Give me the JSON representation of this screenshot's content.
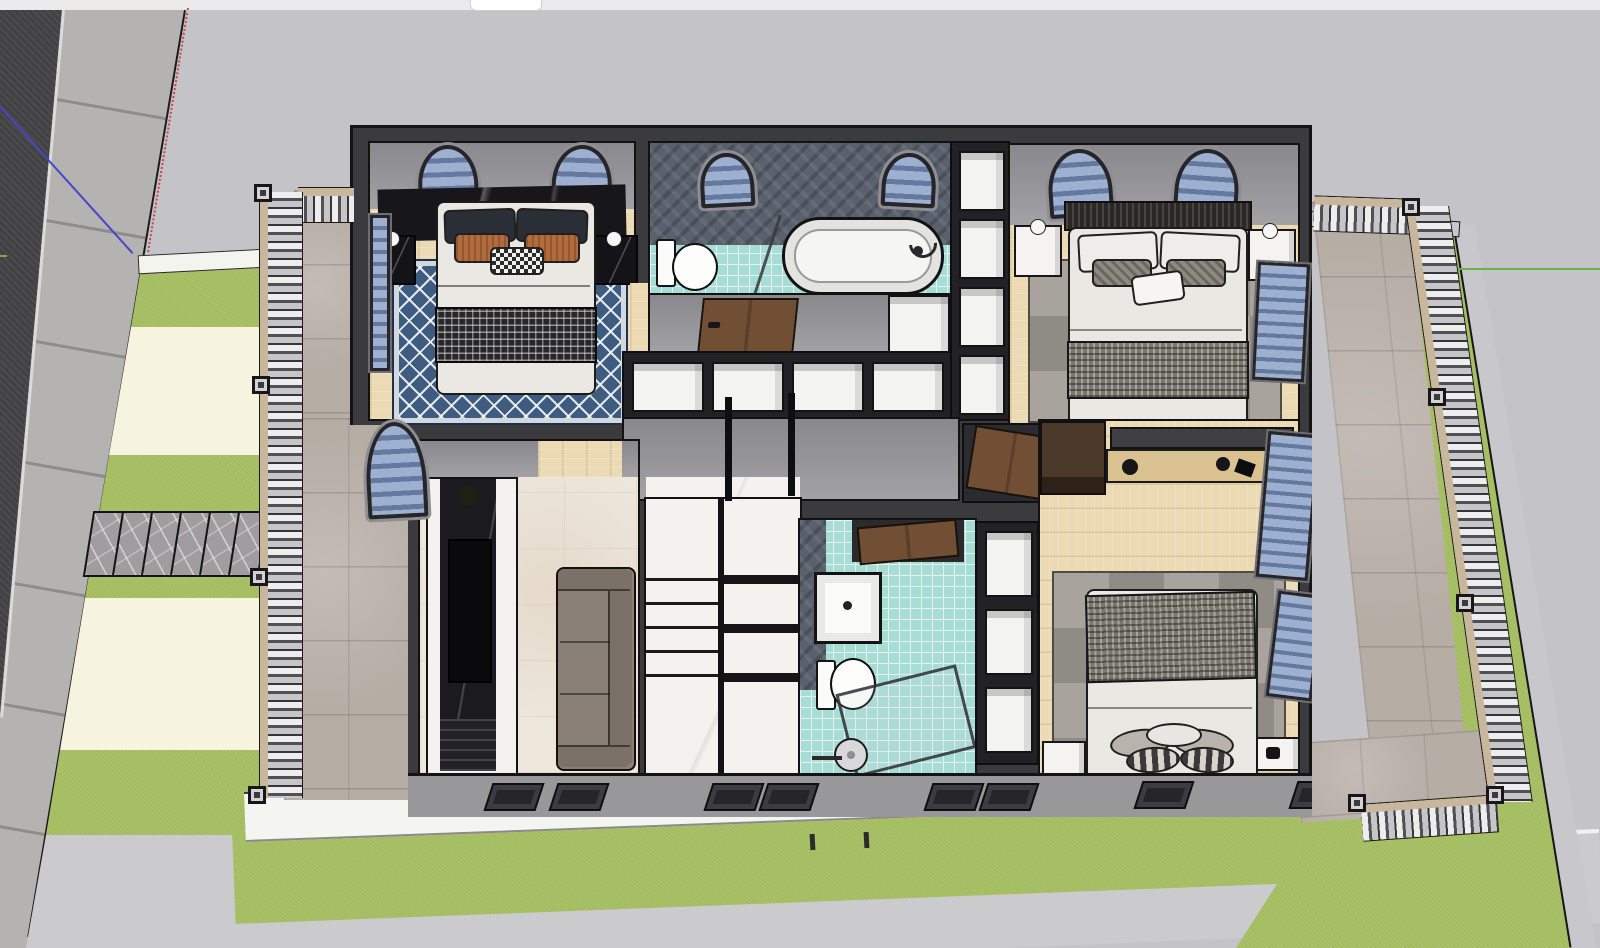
{
  "app": {
    "type": "3d-modeling-viewport",
    "view": "top-down cutaway of second floor of a house model",
    "toolbar_visible": "bottom sliver of toolbar with one white tab"
  },
  "colors": {
    "viewport_bg": "#c4c4c8",
    "topbar": "#eaeaea",
    "tab": "#ffffff",
    "road": "#424245",
    "sidewalk": "#b4b3b1",
    "sidewalk_line": "#8e8d8b",
    "lawn": "#a9c266",
    "ivory": "#f6f3de",
    "paver": "#a09ca0",
    "curb": "#c8c7cb",
    "walkway": "#cbcacd",
    "stone_floor": "#b6ada5",
    "rail_stone": "#c8b69d",
    "wall_cut": "#3b3b3e",
    "wall_face": "#a2a2a5",
    "wall_face_dark": "#89898d",
    "wood": "#ebdab4",
    "beige_tile": "#ede6db",
    "marble": "#f3f2ee",
    "teal": "#a8ddd6",
    "bath_wall": "#59616d",
    "rug_blue": "#3e5c80",
    "rug_gray_a": "#8f8b85",
    "rug_gray_b": "#a8a49d",
    "duvet": "#eae8e3",
    "pillow_navy": "#2a2e37",
    "pillow_rust": "#b26b3c",
    "plaid": "#7a776f",
    "sofa": "#8b8077",
    "sofa_dark": "#7b7168",
    "tv_marble": "#1b1b1f",
    "door": "#714f35",
    "glass": "#9db0d0",
    "glass_dark": "#65789e",
    "frame": "#26262a",
    "lamp": "#f6f6f6",
    "axis_red": "#cc4444",
    "axis_green": "#67b44e",
    "axis_blue": "#4646c8"
  },
  "axes": {
    "red": {
      "style": "dotted",
      "location": "upper-left, along property line"
    },
    "green": {
      "style": "solid",
      "location": "right edge, horizontal"
    },
    "blue": {
      "style": "solid",
      "location": "upper-left, diagonal across road"
    }
  },
  "site": {
    "road": "dark asphalt street, top-left",
    "sidewalk": "concrete sidewalk with slab joints",
    "paver_path": {
      "slabs": 7,
      "material": "veined stone"
    },
    "yard_bands": [
      "lawn",
      "ivory paving",
      "lawn",
      "paver path",
      "lawn",
      "ivory paving",
      "lawn"
    ],
    "front": [
      "white ledge",
      "lawn strip",
      "walkway"
    ],
    "balconies": "stone-tile balconies with classical baluster railings and square posts on left, right and front-right"
  },
  "floorplan": {
    "rooms": [
      {
        "name": "bedroom-1",
        "position": "top-left",
        "floor": "light wood",
        "features": [
          "double bed",
          "navy and rust pillows",
          "patterned throw",
          "blue trellis rug",
          "black marble headboard wall",
          "2 arched windows",
          "2 black marble nightstands with sphere lamps",
          "side window"
        ]
      },
      {
        "name": "bathroom-1",
        "position": "top-middle",
        "floor": "teal mosaic tile",
        "features": [
          "freestanding bathtub",
          "toilet",
          "glass screen",
          "herringbone feature wall",
          "2 arched windows"
        ]
      },
      {
        "name": "corridor",
        "position": "middle",
        "features": [
          "wooden door",
          "built-in wardrobe with 4 white compartments",
          "small closet"
        ]
      },
      {
        "name": "bedroom-2",
        "position": "top-right",
        "floor": "light wood",
        "features": [
          "double bed",
          "houndstooth throw",
          "gray patchwork rug",
          "2 arched windows",
          "2 white nightstands",
          "shelf column with 4 white boxes"
        ]
      },
      {
        "name": "stair-hall",
        "position": "center",
        "floor": "marble",
        "features": [
          "two stair flights",
          "black newel posts",
          "door to bedroom-3"
        ]
      },
      {
        "name": "living-area",
        "position": "bottom-left",
        "floor": "beige tile",
        "features": [
          "gray-brown sofa",
          "black marble TV wall",
          "doorway with wood floor"
        ]
      },
      {
        "name": "bathroom-2",
        "position": "bottom-middle",
        "floor": "teal mosaic tile",
        "features": [
          "vanity sink",
          "toilet",
          "glass shower with round rain head",
          "wooden door"
        ]
      },
      {
        "name": "bedroom-3",
        "position": "bottom-right",
        "floor": "light wood",
        "features": [
          "double bed with plaid blanket",
          "gray patchwork rug",
          "media console with decor",
          "closet",
          "2 white nightstands",
          "side windows"
        ]
      }
    ],
    "stairs": {
      "left_flight_treads": 6,
      "right_flight_treads": 4
    },
    "exterior_wall_windows_bottom": 8
  }
}
